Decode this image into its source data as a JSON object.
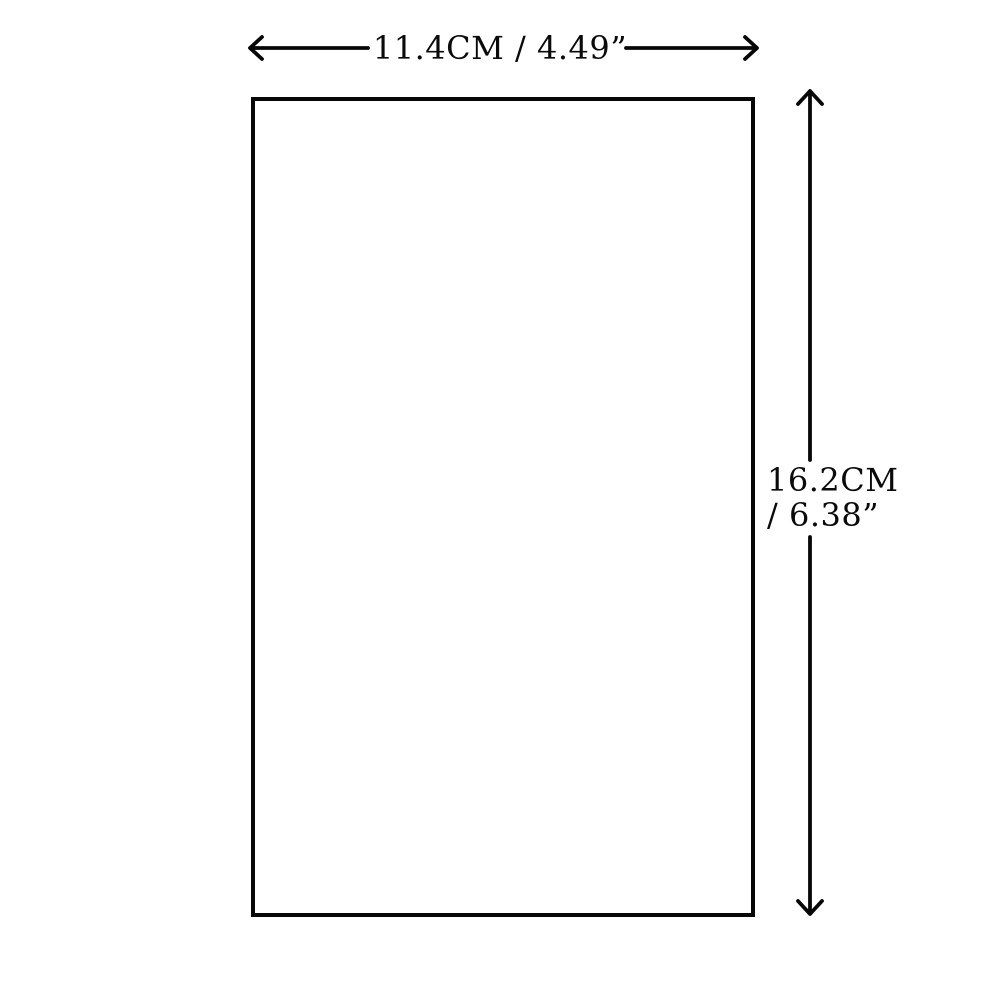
{
  "diagram": {
    "colors": {
      "background": "#ffffff",
      "line": "#070707",
      "text": "#0a0a0a"
    },
    "shape": {
      "type": "rectangle"
    },
    "width_dimension": {
      "label": "11.4CM / 4.49”",
      "cm_value": "11.4CM",
      "inch_value": "4.49”",
      "arrow_icon": "double-headed-horizontal-arrow"
    },
    "height_dimension": {
      "label_line1": "16.2CM",
      "label_line2": "/ 6.38”",
      "cm_value": "16.2CM",
      "inch_value": "6.38”",
      "arrow_icon": "double-headed-vertical-arrow"
    }
  }
}
